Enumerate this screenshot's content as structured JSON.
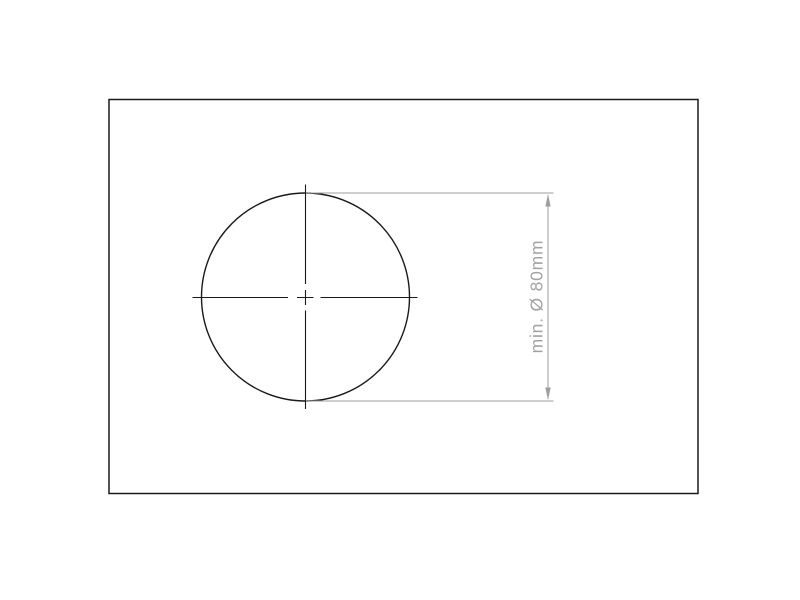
{
  "drawing": {
    "type": "technical-dimension-drawing",
    "dimension": {
      "label": "min. Ø 80mm",
      "prefix": "min.",
      "diameter_symbol": "Ø",
      "value": "80",
      "unit": "mm"
    },
    "icons": {
      "arrow_up": "dimension-arrow-up",
      "arrow_down": "dimension-arrow-down"
    },
    "colors": {
      "line": "#1a1a1a",
      "dim": "#9e9e9e",
      "text": "#a3a3a3",
      "background": "#ffffff"
    }
  }
}
